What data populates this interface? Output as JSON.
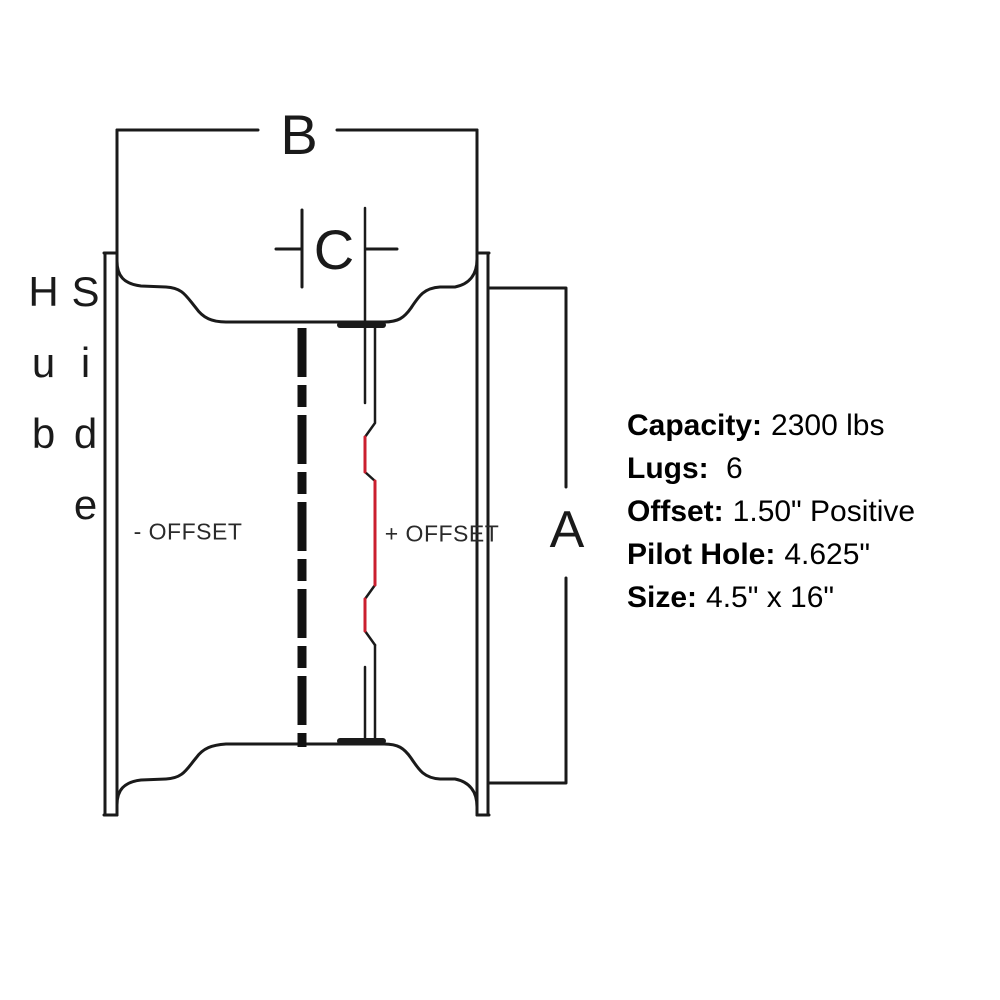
{
  "diagram": {
    "hub_side_label": "Hub Side",
    "dim_b": "B",
    "dim_c": "C",
    "dim_a": "A",
    "offset_negative_label": "- OFFSET",
    "offset_positive_label": "+ OFFSET",
    "colors": {
      "line": "#1a1a1a",
      "mounting_face_highlight": "#cb1f2f",
      "label_text": "#2a2a2a"
    }
  },
  "specs": {
    "items": [
      {
        "label": "Capacity:",
        "value": "2300 lbs"
      },
      {
        "label": "Lugs:",
        "value": " 6"
      },
      {
        "label": "Offset:",
        "value": "1.50\" Positive"
      },
      {
        "label": "Pilot Hole:",
        "value": "4.625\""
      },
      {
        "label": "Size:",
        "value": "4.5\" x 16\""
      }
    ]
  }
}
